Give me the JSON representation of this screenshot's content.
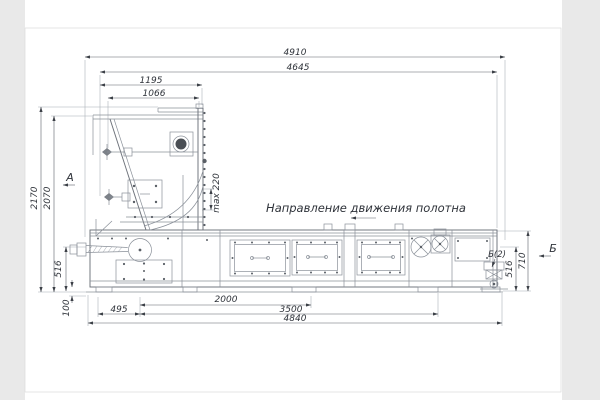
{
  "drawing": {
    "note_direction": "Направление движения полотна",
    "view_a": "А",
    "view_b": "Б",
    "detail_b2": "Б(2)"
  },
  "dimensions": {
    "top_overall": "4910",
    "top_frame": "4645",
    "hopper_width_outer": "1195",
    "hopper_width_inner": "1066",
    "height_overall": "2170",
    "height_hopper": "2070",
    "left_belt_height": "516",
    "base_height": "100",
    "gap_max": "max 220",
    "right_belt_height": "516",
    "right_frame_height": "710",
    "bottom_495": "495",
    "bottom_2000": "2000",
    "bottom_3500": "3500",
    "bottom_overall": "4840"
  },
  "colors": {
    "machine_line": "#8a9099",
    "dimension_line": "#5b6069",
    "text": "#2f333a",
    "background": "#ffffff",
    "page_margin": "#e9e9e9"
  }
}
